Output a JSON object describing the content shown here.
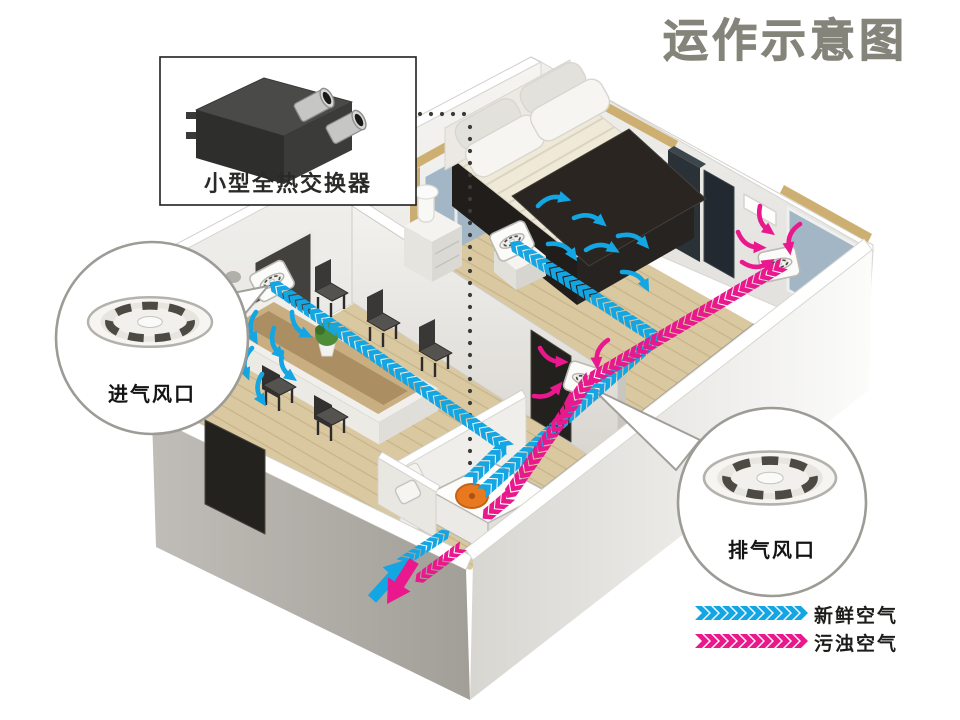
{
  "title": "运作示意图",
  "device_callout": {
    "label": "小型全热交换器"
  },
  "intake_callout": {
    "label": "进气风口"
  },
  "exhaust_callout": {
    "label": "排气风口"
  },
  "legend": {
    "fresh": {
      "label": "新鲜空气",
      "color": "#14a5e3"
    },
    "exhaust": {
      "label": "污浊空气",
      "color": "#e9188c"
    }
  },
  "colors": {
    "title_text": "#84847b",
    "fresh_air": "#14a5e3",
    "exhaust_air": "#e9188c",
    "unit_disc_orange": "#e8791f",
    "wood_floor": "#d9c8a0",
    "wall_white": "#f2f1ee",
    "parapet_brown": "#c9946f"
  }
}
